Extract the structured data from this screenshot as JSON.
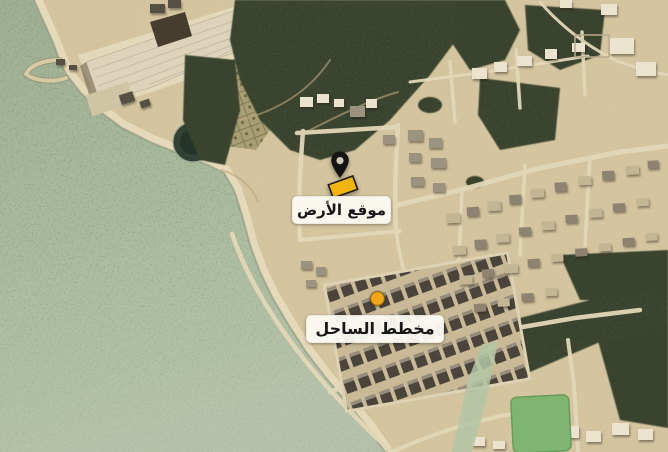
{
  "map": {
    "markers": [
      {
        "id": "land-site",
        "label": "موقع الأرض",
        "marker_type": "pin-with-parcel",
        "accent_color": "#F2B411"
      },
      {
        "id": "coast-plan",
        "label": "مخطط الساحل",
        "marker_type": "dot",
        "accent_color": "#F2A71B"
      }
    ],
    "palette": {
      "water": "#AFC0A4",
      "seagrass_speckle": "#3D4A30",
      "sand": "#D5C5A0",
      "vegetation": "#39432E",
      "road": "#E2D7B8",
      "building_light": "#ECE3CF",
      "field_green": "#7FB571",
      "pin": "#141414",
      "label_background": "#FBF9F2",
      "label_text": "#171717"
    }
  }
}
